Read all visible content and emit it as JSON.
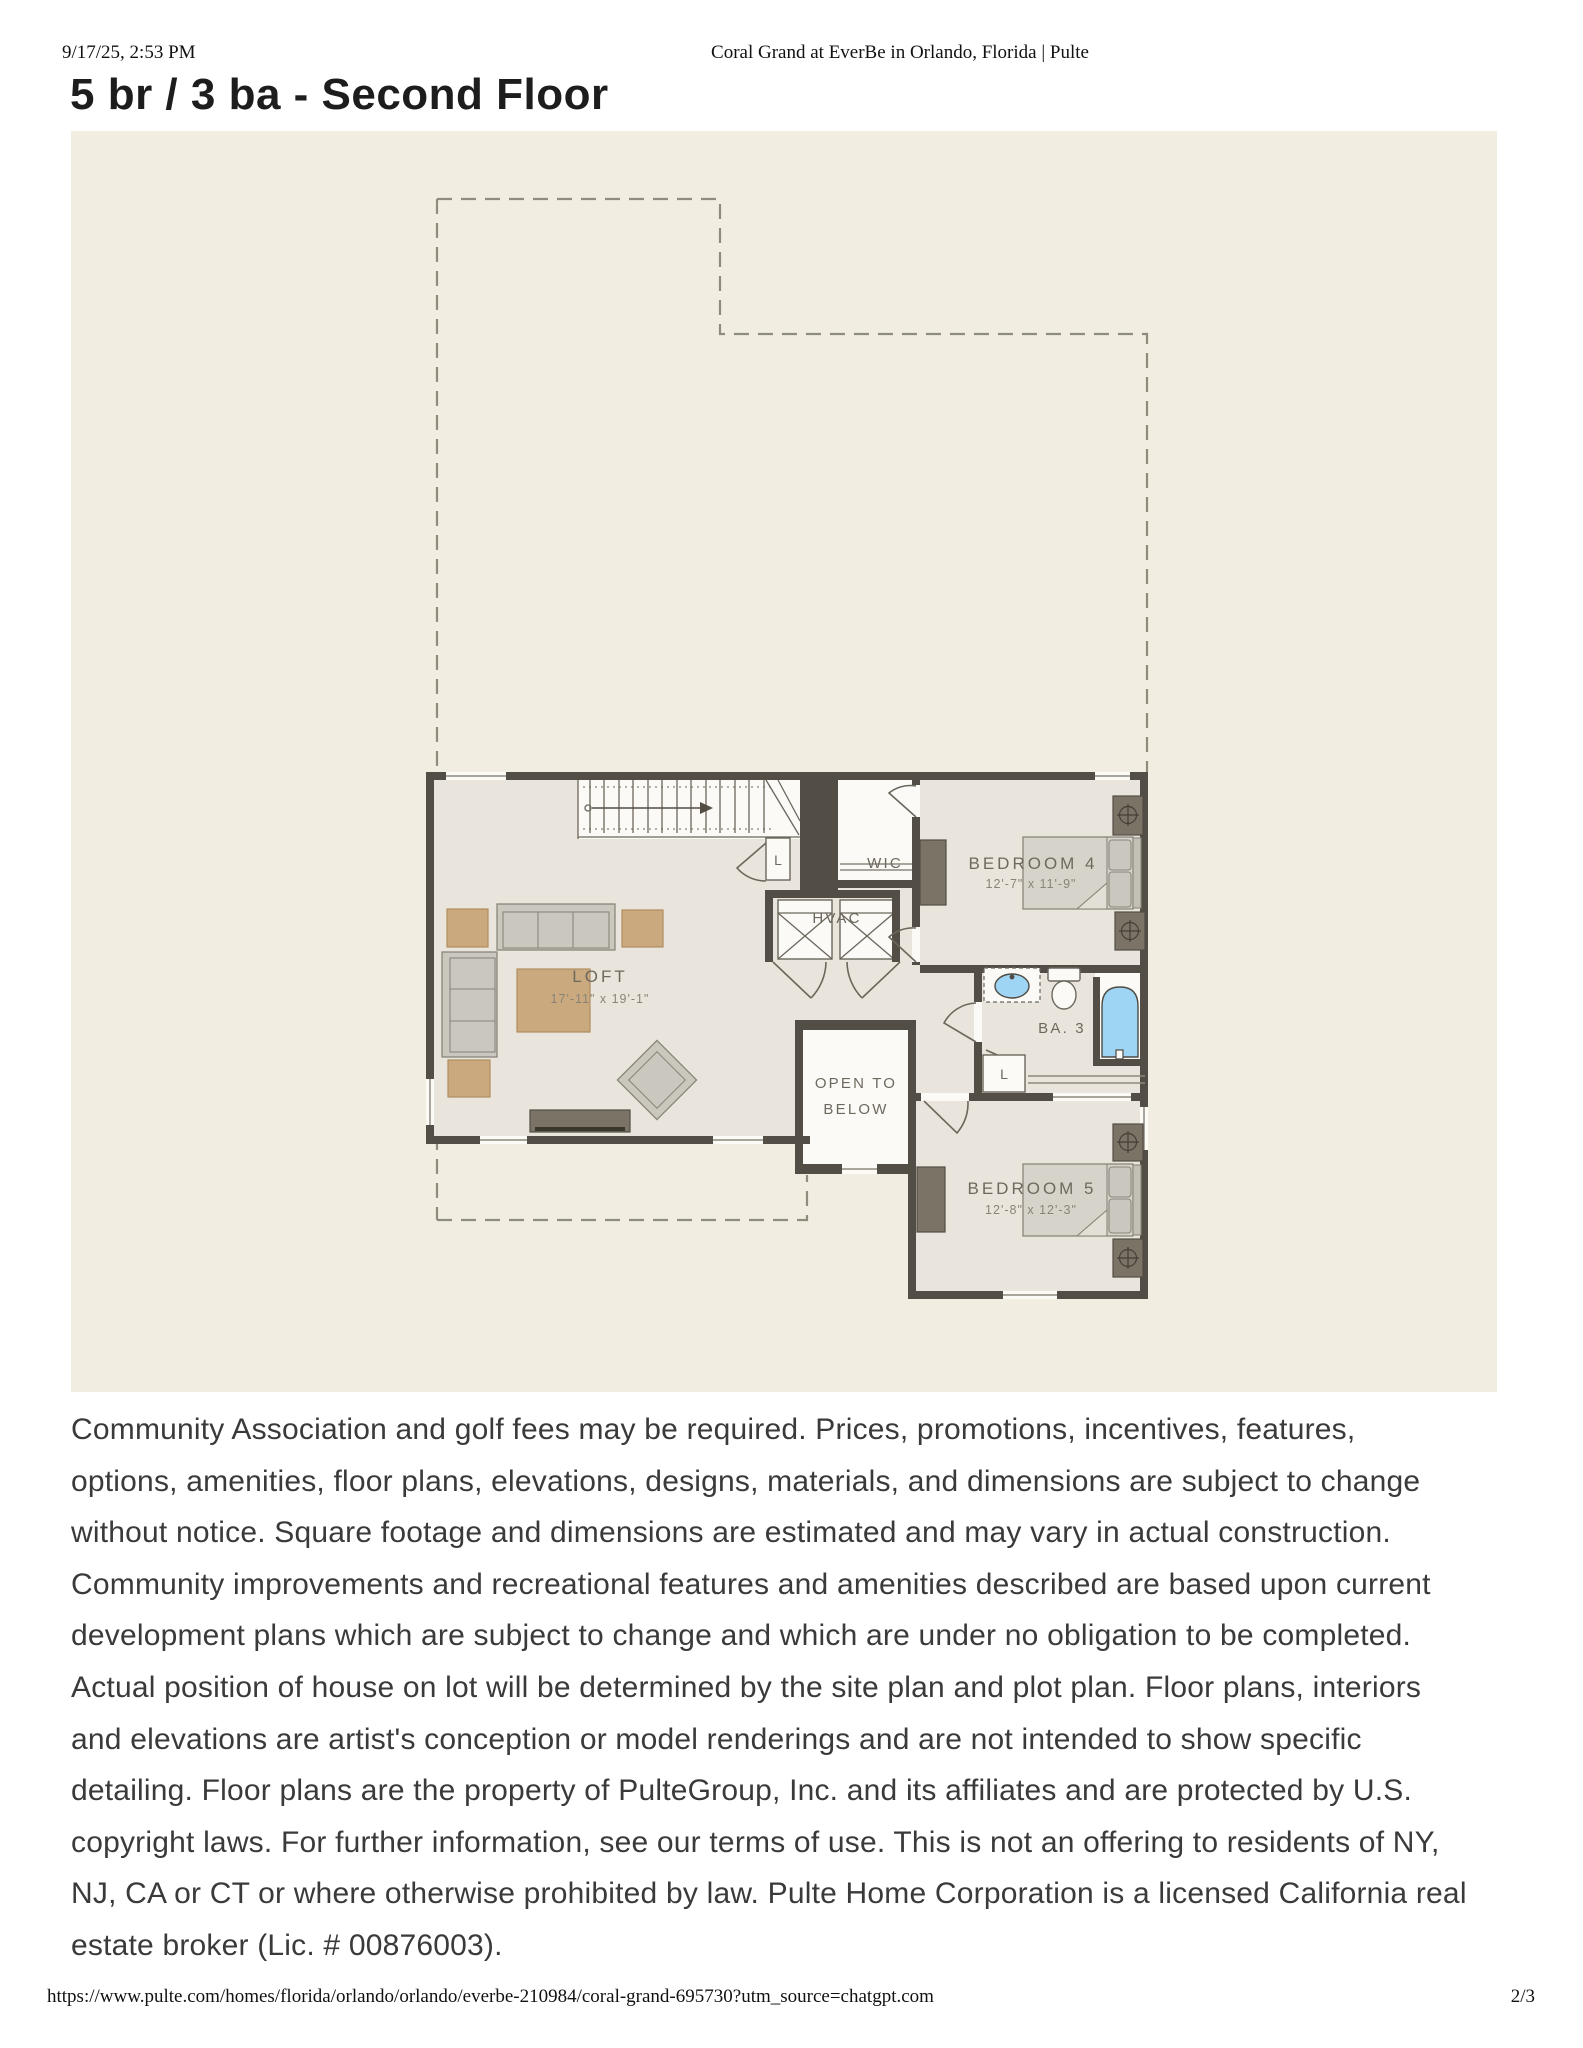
{
  "page": {
    "print_header": {
      "timestamp": "9/17/25, 2:53 PM",
      "title": "Coral Grand at EverBe in Orlando, Florida | Pulte"
    },
    "heading": "5 br / 3 ba - Second Floor",
    "disclaimer_lines": [
      "Community Association and golf fees may be required. Prices, promotions, incentives, features,",
      "options, amenities, floor plans, elevations, designs, materials, and dimensions are subject to change",
      "without notice. Square footage and dimensions are estimated and may vary in actual construction.",
      "Community improvements and recreational features and amenities described are based upon current",
      "development plans which are subject to change and which are under no obligation to be completed.",
      "Actual position of house on lot will be determined by the site plan and plot plan. Floor plans, interiors",
      "and elevations are artist's conception or model renderings and are not intended to show specific",
      "detailing. Floor plans are the property of PulteGroup, Inc. and its affiliates and are protected by U.S.",
      "copyright laws. For further information, see our terms of use. This is not an offering to residents of NY,",
      "NJ, CA or CT or where otherwise prohibited by law. Pulte Home Corporation is a licensed California real",
      "estate broker (Lic. # 00876003)."
    ],
    "print_footer": {
      "url": "https://www.pulte.com/homes/florida/orlando/orlando/everbe-210984/coral-grand-695730?utm_source=chatgpt.com",
      "page_indicator": "2/3"
    }
  },
  "floor_plan": {
    "labels": {
      "loft": "LOFT",
      "loft_dims": "17'-11\" x 19'-1\"",
      "wic": "WIC",
      "hvac": "HVAC",
      "bedroom4": "BEDROOM 4",
      "bedroom4_dims": "12'-7\" x 11'-9\"",
      "bath3": "BA. 3",
      "bedroom5": "BEDROOM 5",
      "bedroom5_dims": "12'-8\" x 12'-3\"",
      "open_to_below_line1": "OPEN TO",
      "open_to_below_line2": "BELOW",
      "linen_stairs": "L",
      "linen_bath": "L"
    },
    "colors": {
      "plan_background": "#f1eee1",
      "room_fill": "#e9e5dc",
      "wall": "#524d45",
      "furniture_tan": "#c9a97d",
      "furniture_gray": "#cac7bf",
      "furniture_dark": "#7b7365",
      "fixture_blue": "#9ed5f4",
      "label_text": "#6e695f"
    }
  }
}
